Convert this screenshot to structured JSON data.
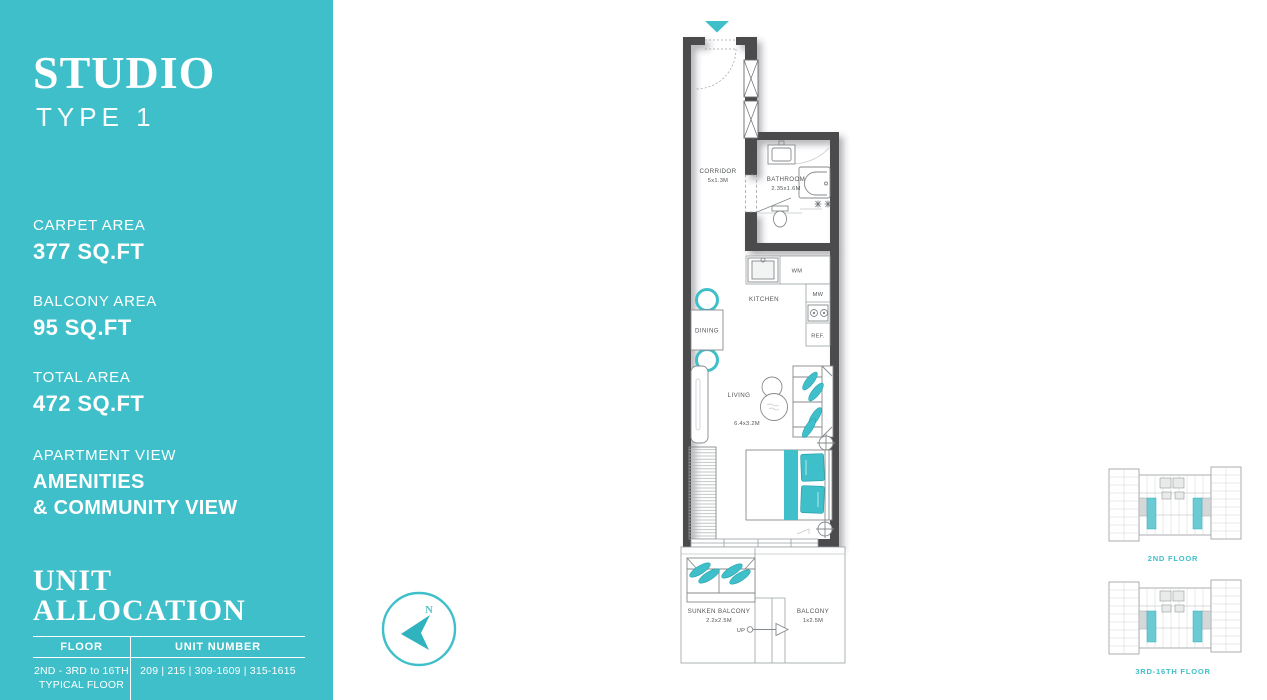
{
  "theme": {
    "accent": "#3FBFC9",
    "accentDark": "#2FB3BF",
    "wall": "#4C4C4E"
  },
  "sidebar": {
    "title": "STUDIO",
    "subtitle": "TYPE 1",
    "stats": [
      {
        "label": "CARPET AREA",
        "value": "377 SQ.FT"
      },
      {
        "label": "BALCONY AREA",
        "value": "95 SQ.FT"
      },
      {
        "label": "TOTAL AREA",
        "value": "472 SQ.FT"
      }
    ],
    "view": {
      "label": "APARTMENT VIEW",
      "value": "AMENITIES\n& COMMUNITY VIEW"
    },
    "allocation": {
      "title": "UNIT ALLOCATION",
      "columns": [
        "FLOOR",
        "UNIT NUMBER"
      ],
      "rows": [
        {
          "floor": "2ND - 3RD to 16TH\nTYPICAL FLOOR",
          "units": "209 | 215 | 309-1609 | 315-1615"
        }
      ]
    }
  },
  "plan": {
    "rooms": [
      {
        "name": "CORRIDOR",
        "dim": "5x1.3M"
      },
      {
        "name": "BATHROOM",
        "dim": "2.35x1.6M"
      },
      {
        "name": "KITCHEN",
        "dim": ""
      },
      {
        "name": "DINING",
        "dim": ""
      },
      {
        "name": "LIVING",
        "dim": "6.4x3.2M"
      },
      {
        "name": "SUNKEN BALCONY",
        "dim": "2.2x2.5M"
      },
      {
        "name": "BALCONY",
        "dim": "1x2.5M"
      }
    ],
    "appliances": [
      "WM",
      "MW",
      "REF."
    ],
    "up_label": "UP"
  },
  "compass": {
    "north_label": "N"
  },
  "keyplans": [
    {
      "label": "2ND FLOOR"
    },
    {
      "label": "3RD-16TH FLOOR"
    }
  ]
}
